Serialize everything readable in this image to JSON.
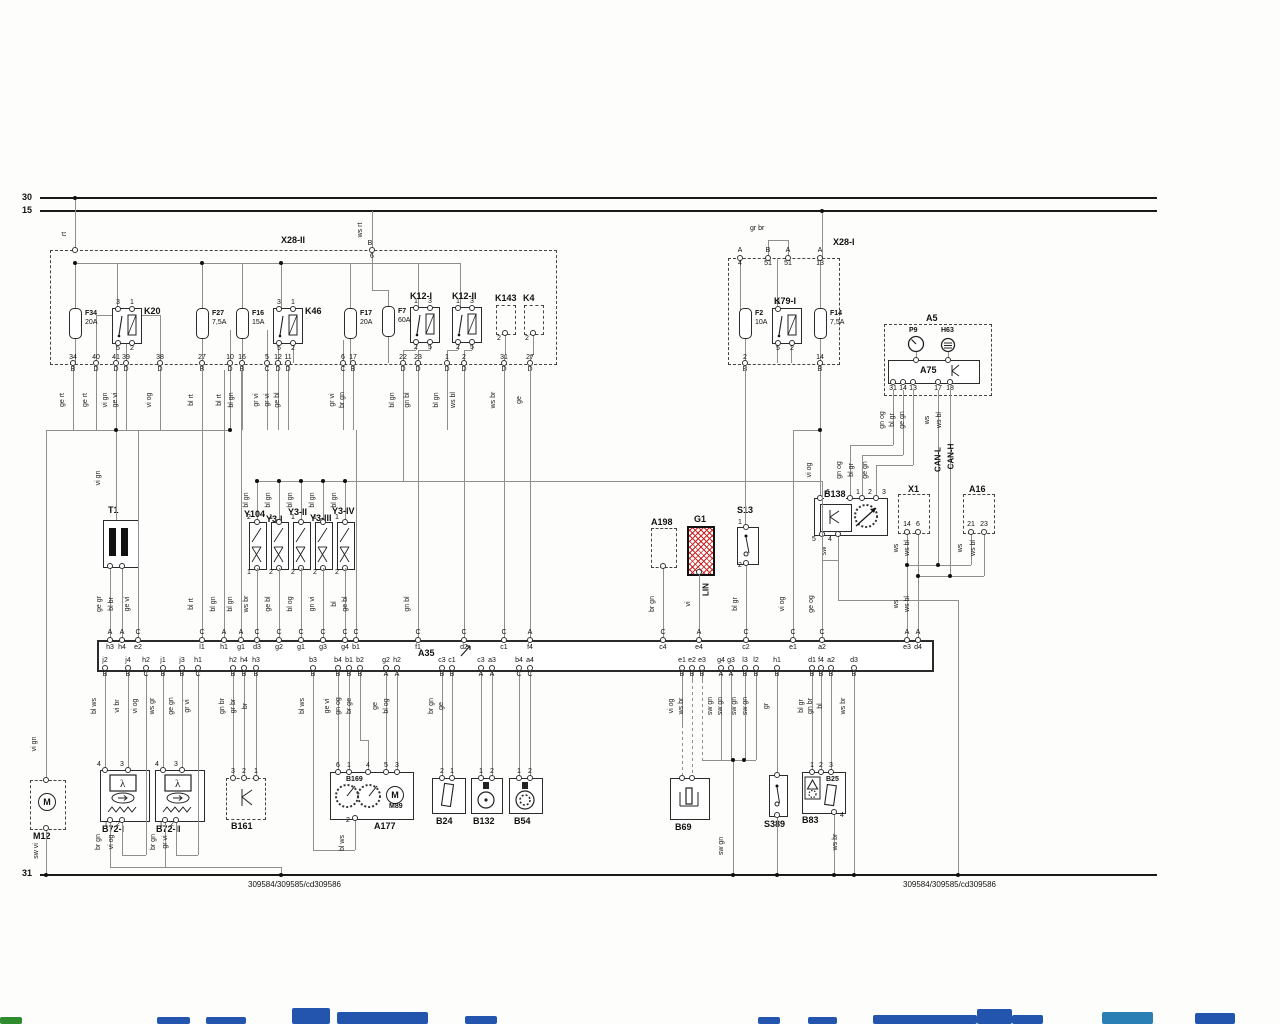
{
  "buses": {
    "b30": "30",
    "b15": "15",
    "b31": "31"
  },
  "footer": {
    "left": "309584/309585/cd309586",
    "right": "309584/309585/cd309586"
  },
  "labels": {
    "rt": "rt",
    "ws_rt": "ws rt",
    "b": "B",
    "n6": "6",
    "gr_br": "gr br",
    "vi_gn_t1": "vi gn",
    "vi_gn_m12": "vi gn",
    "sw_vi": "sw vi",
    "sw_gn": "sw gn",
    "sw": "sw",
    "ws_br_b83": "ws br",
    "bl_ws_a177": "bl ws",
    "br_gn_1": "br gn",
    "vi_og_1": "vi og",
    "br_gn_2": "br gn",
    "gr_vi_2": "gr vi",
    "lin": "LIN",
    "can_l": "CAN-L",
    "can_h": "CAN-H"
  },
  "x28ii": {
    "label": "X28-II",
    "pins": [
      {
        "n": "34",
        "l": "B",
        "c": "ge rt"
      },
      {
        "n": "40",
        "l": "D",
        "c": "ge rt"
      },
      {
        "n": "41",
        "l": "D",
        "c": "vi gn"
      },
      {
        "n": "39",
        "l": "D",
        "c": "ge vi"
      },
      {
        "n": "38",
        "l": "D",
        "c": "vi og"
      },
      {
        "n": "27",
        "l": "B",
        "c": "bl rt"
      },
      {
        "n": "10",
        "l": "D",
        "c": "bl rt"
      },
      {
        "n": "16",
        "l": "B",
        "c": "bl gn"
      },
      {
        "n": "5",
        "l": "C",
        "c": "gr vi"
      },
      {
        "n": "12",
        "l": "D",
        "c": "gr vi"
      },
      {
        "n": "11",
        "l": "D",
        "c": "ge bl"
      },
      {
        "n": "6",
        "l": "C",
        "c": "gr vi"
      },
      {
        "n": "17",
        "l": "B",
        "c": "br gn"
      },
      {
        "n": "22",
        "l": "D",
        "c": "bl gn"
      },
      {
        "n": "23",
        "l": "D",
        "c": "gn bl"
      },
      {
        "n": "1",
        "l": "D",
        "c": "bl gn"
      },
      {
        "n": "2",
        "l": "D",
        "c": "ws bl"
      },
      {
        "n": "31",
        "l": "D",
        "c": "ws br"
      },
      {
        "n": "27",
        "l": "D",
        "c": "ge"
      }
    ]
  },
  "x28i": {
    "label": "X28-I",
    "top_pins": [
      {
        "l": "A",
        "n": "4"
      },
      {
        "l": "B",
        "n": "51"
      },
      {
        "l": "A",
        "n": "51"
      },
      {
        "l": "A",
        "n": "13"
      }
    ],
    "bottom_pins": [
      {
        "n": "2",
        "l": "B"
      },
      {
        "n": "14",
        "l": "B"
      }
    ]
  },
  "fuses": [
    {
      "id": "F34",
      "amp": "20A"
    },
    {
      "id": "F27",
      "amp": "7,5A"
    },
    {
      "id": "F16",
      "amp": "15A"
    },
    {
      "id": "F17",
      "amp": "20A"
    },
    {
      "id": "F7",
      "amp": "60A"
    },
    {
      "id": "F2",
      "amp": "10A"
    },
    {
      "id": "F14",
      "amp": "7,5A"
    }
  ],
  "relays": [
    {
      "id": "K20",
      "top": [
        "3",
        "1"
      ],
      "bot": [
        "5",
        "2"
      ]
    },
    {
      "id": "K46",
      "top": [
        "3",
        "1"
      ],
      "bot": [
        "5",
        "2"
      ]
    },
    {
      "id": "K12-I",
      "top": [
        "1",
        "3"
      ],
      "bot": [
        "2",
        "5"
      ]
    },
    {
      "id": "K12-II",
      "top": [
        "1",
        "3"
      ],
      "bot": [
        "2",
        "5"
      ]
    },
    {
      "id": "K79-I",
      "top": [
        "3"
      ],
      "bot": [
        "5",
        "2"
      ]
    }
  ],
  "k143": {
    "label": "K143",
    "pin": "2"
  },
  "k4": {
    "label": "K4",
    "pin": "2"
  },
  "a5": {
    "label": "A5",
    "p9": "P9",
    "h63": "H63",
    "a75": "A75",
    "pins": [
      {
        "n": "31",
        "c": "gn og"
      },
      {
        "n": "14",
        "c": "bl gr"
      },
      {
        "n": "13",
        "c": "ge gn"
      },
      {
        "n": "17",
        "c": "ws"
      },
      {
        "n": "18",
        "c": "ws bl"
      }
    ]
  },
  "b138": {
    "label": "B138",
    "top": [
      {
        "n": "6",
        "c": "vi og"
      },
      {
        "n": "1",
        "c": "gn og"
      },
      {
        "n": "2",
        "c": "bl gr"
      },
      {
        "n": "3",
        "c": "ge gn"
      }
    ],
    "bot": [
      {
        "n": "5",
        "c": ""
      },
      {
        "n": "4",
        "c": "sw"
      }
    ]
  },
  "x1": {
    "label": "X1",
    "pins": [
      {
        "n": "14",
        "c": "ws"
      },
      {
        "n": "6",
        "c": "ws bl"
      }
    ]
  },
  "a16": {
    "label": "A16",
    "pins": [
      {
        "n": "21",
        "c": "ws"
      },
      {
        "n": "23",
        "c": "ws bl"
      }
    ]
  },
  "t1": {
    "label": "T1"
  },
  "valves": [
    {
      "id": "Y104",
      "t": "2",
      "b": "1",
      "c": "bl gn"
    },
    {
      "id": "Y3-I",
      "t": "1",
      "b": "2",
      "c": "bl gn"
    },
    {
      "id": "Y3-II",
      "t": "1",
      "b": "2",
      "c": "bl gn"
    },
    {
      "id": "Y3-III",
      "t": "1",
      "b": "2",
      "c": "bl gn"
    },
    {
      "id": "Y3-IV",
      "t": "1",
      "b": "2",
      "c": "bl gn"
    }
  ],
  "a198": {
    "label": "A198"
  },
  "g1": {
    "label": "G1"
  },
  "s13": {
    "label": "S13",
    "t": "1",
    "b": "2"
  },
  "a35": {
    "label": "A35",
    "top": [
      {
        "l": "A",
        "n": "h3",
        "c": "ge gr"
      },
      {
        "l": "A",
        "n": "h4",
        "c": "bl br"
      },
      {
        "l": "C",
        "n": "e2",
        "c": "ge vi"
      },
      {
        "l": "C",
        "n": "l1",
        "c": "bl rt"
      },
      {
        "l": "A",
        "n": "h1",
        "c": "bl gn"
      },
      {
        "l": "A",
        "n": "g1",
        "c": "bl gn"
      },
      {
        "l": "C",
        "n": "d3",
        "c": "ws br"
      },
      {
        "l": "C",
        "n": "g2",
        "c": "ge bl"
      },
      {
        "l": "C",
        "n": "g1",
        "c": "bl og"
      },
      {
        "l": "C",
        "n": "g3",
        "c": "gn vi"
      },
      {
        "l": "C",
        "n": "g4",
        "c": "bl"
      },
      {
        "l": "C",
        "n": "b1",
        "c": "ge bl"
      },
      {
        "l": "C",
        "n": "f1",
        "c": "gn bl"
      },
      {
        "l": "C",
        "n": "d2",
        "c": ""
      },
      {
        "l": "C",
        "n": "c1",
        "c": ""
      },
      {
        "l": "A",
        "n": "f4",
        "c": ""
      },
      {
        "l": "C",
        "n": "c4",
        "c": "br gn"
      },
      {
        "l": "A",
        "n": "e4",
        "c": "vi"
      },
      {
        "l": "C",
        "n": "c2",
        "c": "bl gr"
      },
      {
        "l": "C",
        "n": "e1",
        "c": "vi og"
      },
      {
        "l": "C",
        "n": "a2",
        "c": "ge og"
      },
      {
        "l": "A",
        "n": "e3",
        "c": "ws"
      },
      {
        "l": "A",
        "n": "d4",
        "c": "ws bl"
      }
    ],
    "bottom": [
      {
        "n": "j2",
        "l": "B",
        "c": "bl ws"
      },
      {
        "n": "j4",
        "l": "B",
        "c": "vi br"
      },
      {
        "n": "h2",
        "l": "C",
        "c": "vi og"
      },
      {
        "n": "j1",
        "l": "B",
        "c": "ws gr"
      },
      {
        "n": "j3",
        "l": "B",
        "c": "ge gn"
      },
      {
        "n": "h1",
        "l": "C",
        "c": "gr vi"
      },
      {
        "n": "h2",
        "l": "B",
        "c": "gn br"
      },
      {
        "n": "h4",
        "l": "B",
        "c": "gr br"
      },
      {
        "n": "h3",
        "l": "B",
        "c": "br"
      },
      {
        "n": "b3",
        "l": "B",
        "c": "bl ws"
      },
      {
        "n": "b4",
        "l": "B",
        "c": "ge vi"
      },
      {
        "n": "b1",
        "l": "B",
        "c": "gn og"
      },
      {
        "n": "b2",
        "l": "B",
        "c": "br ge"
      },
      {
        "n": "g2",
        "l": "A",
        "c": "ge"
      },
      {
        "n": "h2",
        "l": "A",
        "c": "bl og"
      },
      {
        "n": "c3",
        "l": "B",
        "c": "br gn"
      },
      {
        "n": "c1",
        "l": "B",
        "c": "ge"
      },
      {
        "n": "c3",
        "l": "A",
        "c": ""
      },
      {
        "n": "a3",
        "l": "A",
        "c": ""
      },
      {
        "n": "b4",
        "l": "C",
        "c": ""
      },
      {
        "n": "a4",
        "l": "C",
        "c": ""
      },
      {
        "n": "e1",
        "l": "B",
        "c": "vi og"
      },
      {
        "n": "e2",
        "l": "B",
        "c": "ws br"
      },
      {
        "n": "e3",
        "l": "B",
        "c": ""
      },
      {
        "n": "g4",
        "l": "A",
        "c": "sw gn"
      },
      {
        "n": "g3",
        "l": "A",
        "c": "sw gn"
      },
      {
        "n": "l3",
        "l": "B",
        "c": "sw gn"
      },
      {
        "n": "l2",
        "l": "B",
        "c": "sw gn"
      },
      {
        "n": "h1",
        "l": "B",
        "c": "gr"
      },
      {
        "n": "d1",
        "l": "B",
        "c": "bl gr"
      },
      {
        "n": "f4",
        "l": "B",
        "c": "gn br"
      },
      {
        "n": "a2",
        "l": "B",
        "c": "bl"
      },
      {
        "n": "d3",
        "l": "B",
        "c": "ws br"
      }
    ]
  },
  "m12": {
    "label": "M12"
  },
  "b72i": {
    "label": "B72-I",
    "pins_top": [
      "4",
      "3"
    ],
    "pins_bot": [
      "1",
      "2"
    ]
  },
  "b72ii": {
    "label": "B72-II",
    "pins_top": [
      "4",
      "3"
    ],
    "pins_bot": [
      "1",
      "2"
    ]
  },
  "b161": {
    "label": "B161",
    "pins": [
      "3",
      "2",
      "1"
    ]
  },
  "a177": {
    "label": "A177",
    "b169": "B169",
    "m89": "M89",
    "pins_top": [
      "6",
      "1",
      "4",
      "5",
      "3"
    ],
    "pin_bot": "2"
  },
  "b24": {
    "label": "B24",
    "pins": [
      "2",
      "1"
    ]
  },
  "b132": {
    "label": "B132",
    "pins": [
      "1",
      "2"
    ]
  },
  "b54": {
    "label": "B54",
    "pins": [
      "1",
      "2"
    ]
  },
  "b69": {
    "label": "B69"
  },
  "s389": {
    "label": "S389"
  },
  "b83": {
    "label": "B83",
    "b25": "B25",
    "pins_top": [
      "1",
      "2",
      "3"
    ],
    "pin_bot": "4"
  }
}
